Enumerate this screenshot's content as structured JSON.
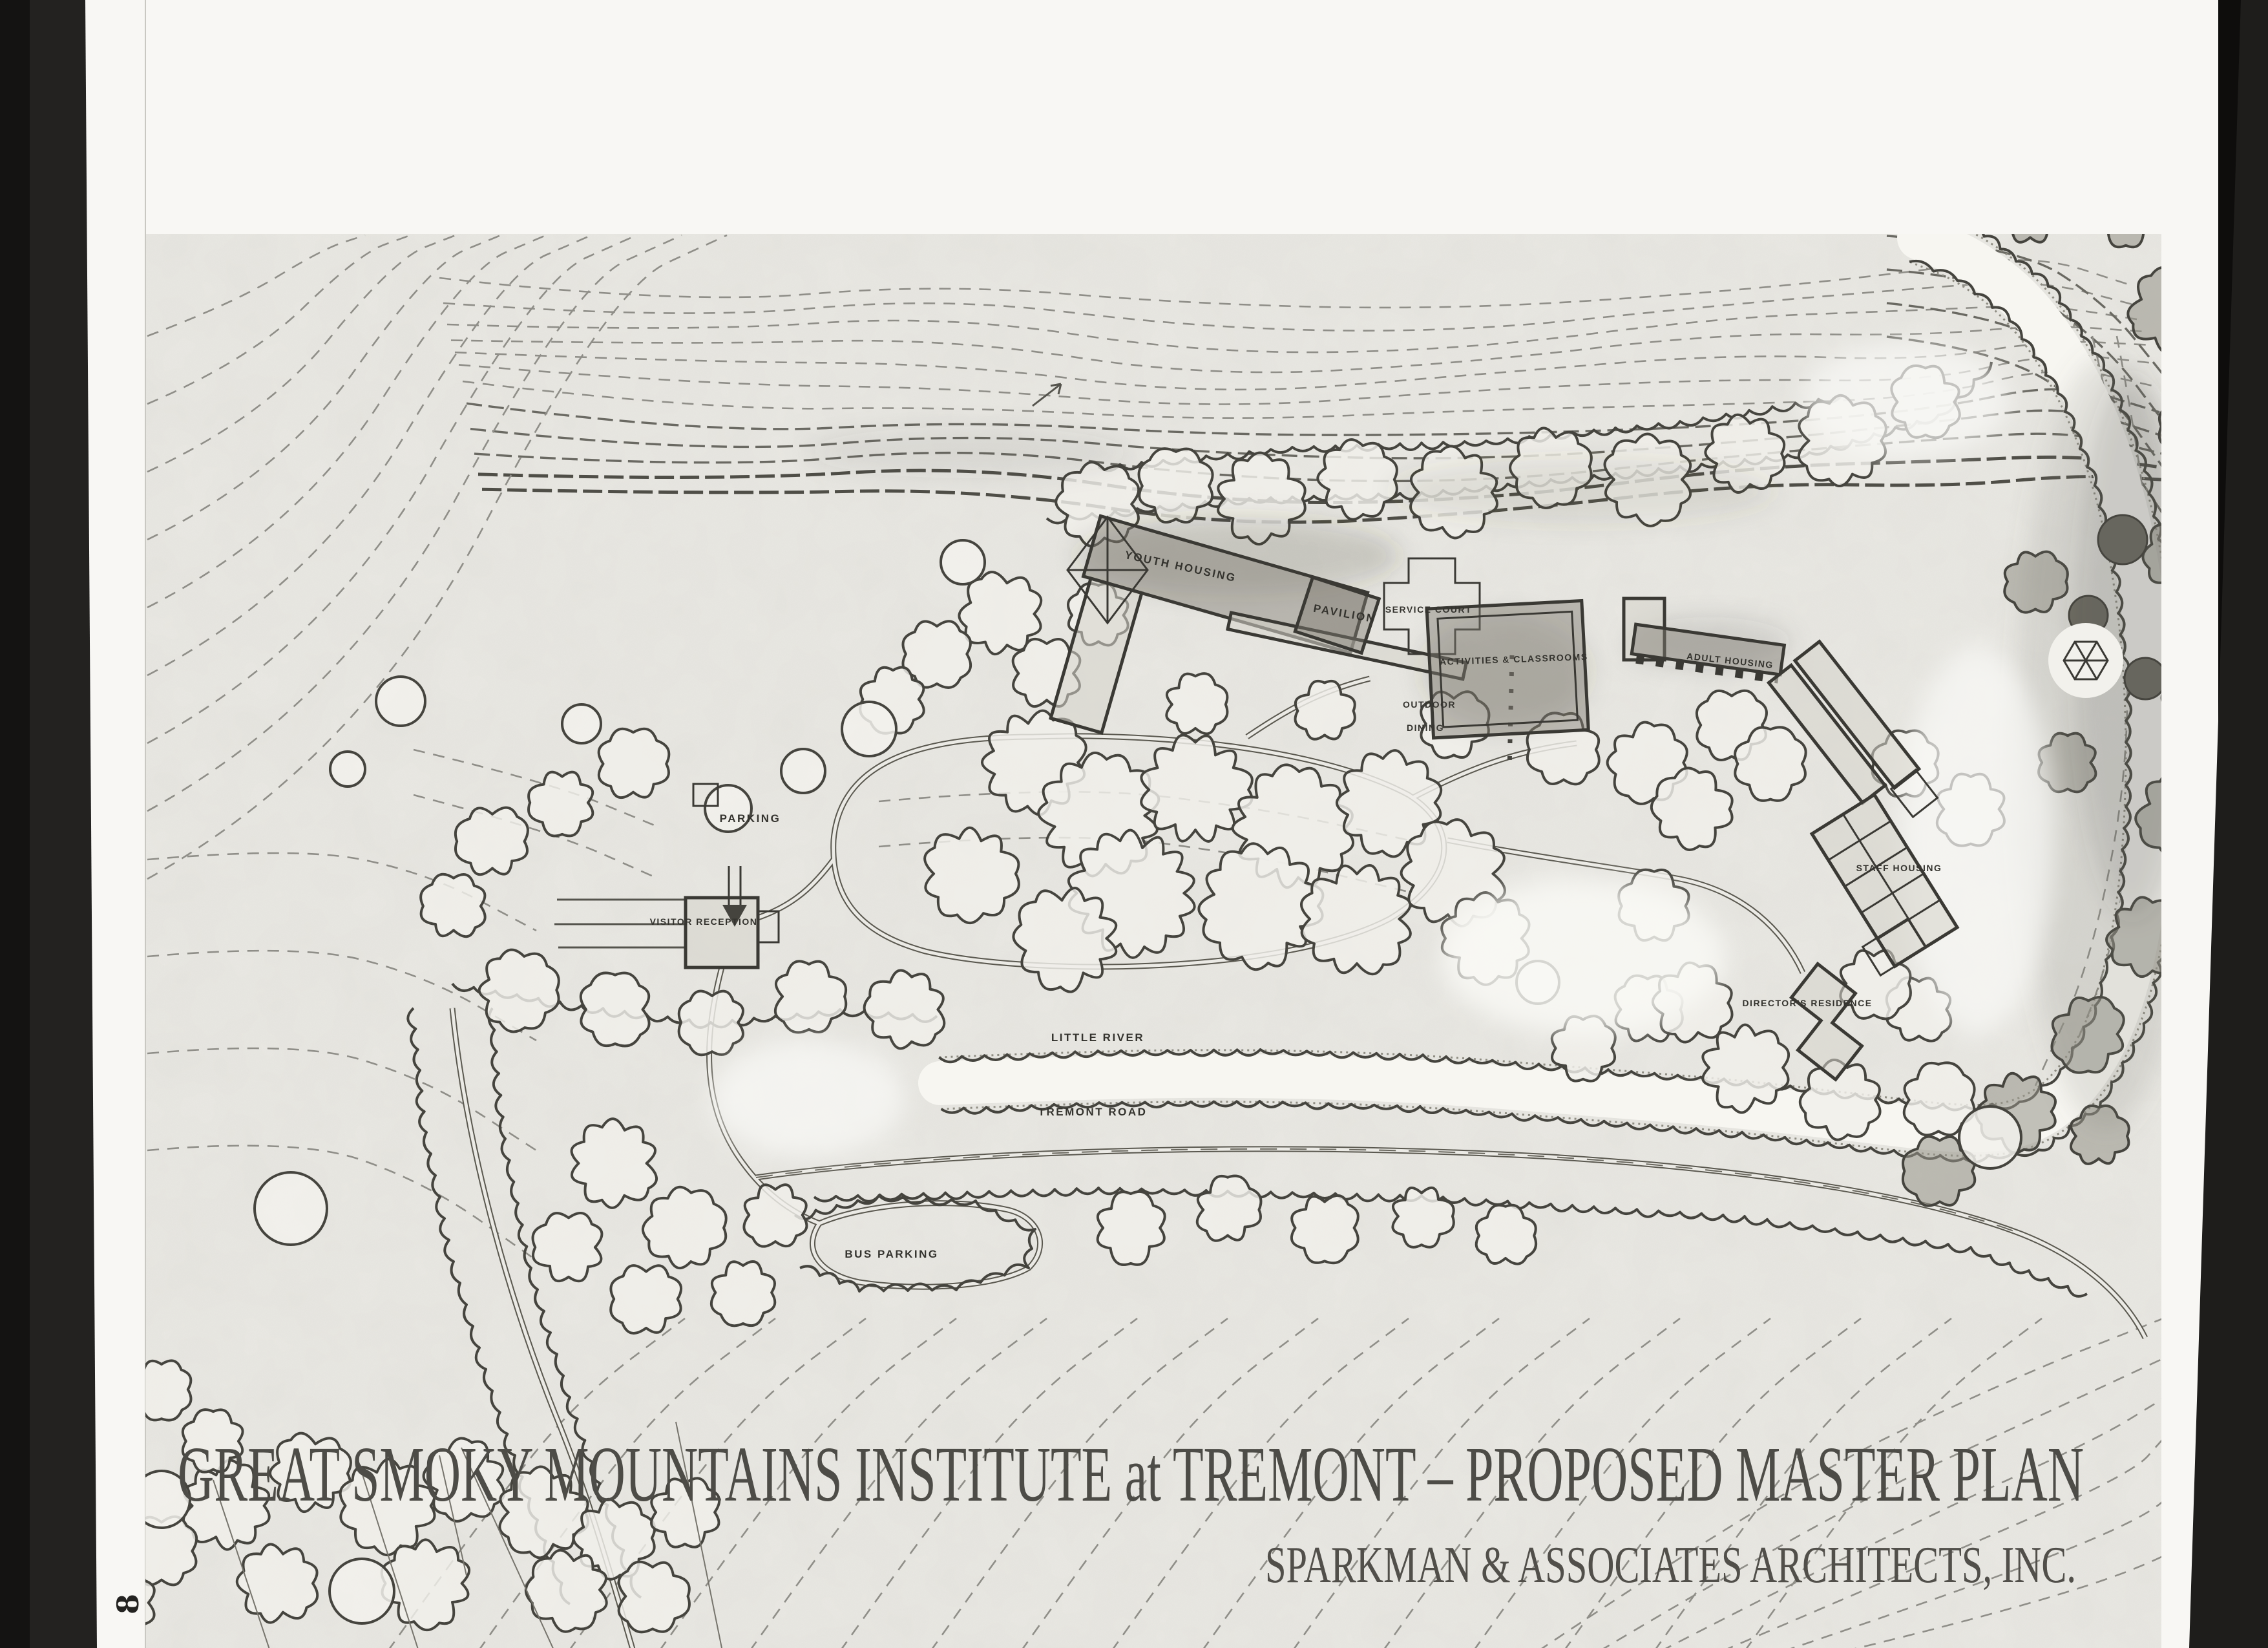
{
  "page": {
    "page_number": "8",
    "title": "GREAT SMOKY MOUNTAINS INSTITUTE at TREMONT – PROPOSED MASTER PLAN",
    "credit": "SPARKMAN & ASSOCIATES ARCHITECTS, INC."
  },
  "plan_labels": {
    "youth_housing": "YOUTH HOUSING",
    "pavilion": "PAVILION",
    "service_court": "SERVICE COURT",
    "outdoor_dining_line1": "OUTDOOR",
    "outdoor_dining_line2": "DINING",
    "activities_classrooms": "ACTIVITIES & CLASSROOMS",
    "adult_housing": "ADULT HOUSING",
    "parking": "PARKING",
    "visitor_reception": "VISITOR RECEPTION",
    "staff_housing": "STAFF HOUSING",
    "directors_residence": "DIRECTOR'S RESIDENCE",
    "little_river": "LITTLE RIVER",
    "tremont_road": "TREMONT ROAD",
    "bus_parking": "BUS PARKING"
  },
  "colors": {
    "paper": "#f8f7f4",
    "map_background": "#ebeae5",
    "ink": "#3a3934",
    "scanner_black": "#1c1b1a"
  }
}
